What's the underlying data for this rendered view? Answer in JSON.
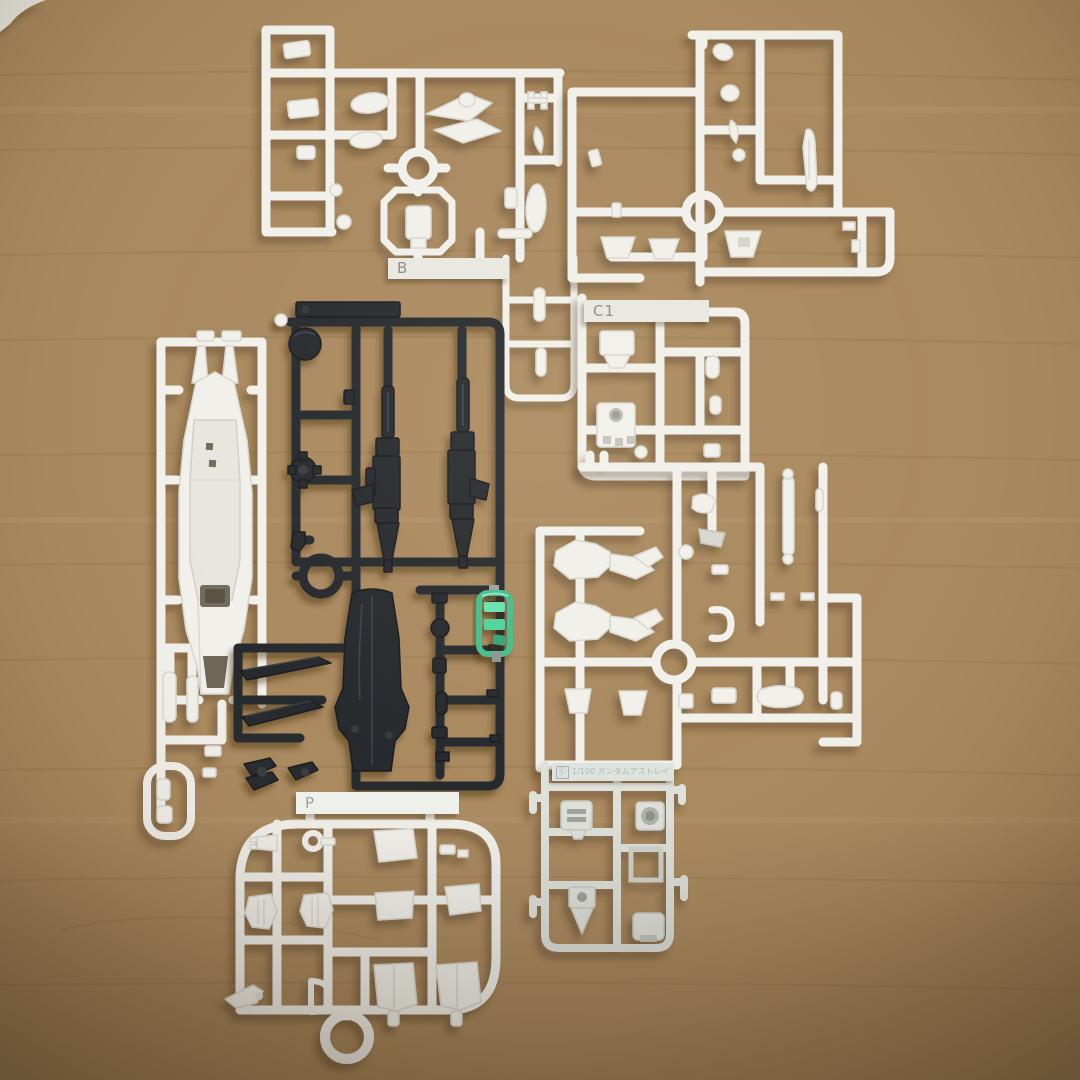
{
  "scene": {
    "surface": "wood-table"
  },
  "colors": {
    "wood": "#a8875c",
    "wood_dark": "#7c5f3c",
    "wood_light": "#b4946a",
    "plastic_white": "#f1f0ea",
    "plastic_white_edge": "#d7d6cd",
    "plastic_gray": "#dde0da",
    "plastic_gray_edge": "#c4c8c1",
    "plastic_black": "#23262a",
    "plastic_black_edge": "#15181b",
    "clear_green": "#3fbd8a",
    "clear_green_bright": "#63e2ad"
  },
  "sprues": {
    "b": {
      "label": "B"
    },
    "c1": {
      "label": "C1"
    },
    "p": {
      "label": "P"
    },
    "nameplate": {
      "copyright": "Ⓒ",
      "text": "1/100 ガンダムアストレイ"
    }
  }
}
